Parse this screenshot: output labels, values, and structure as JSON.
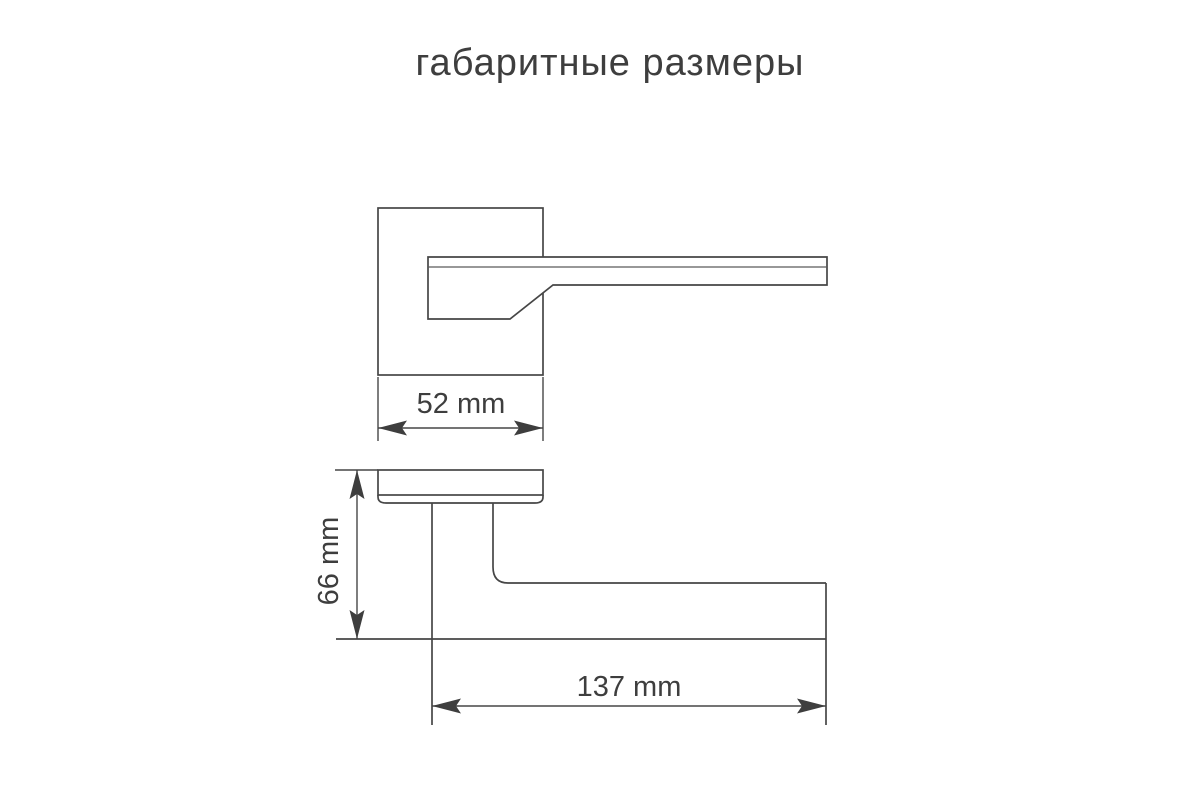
{
  "title": "габаритные размеры",
  "drawing": {
    "type": "technical-dimension-drawing",
    "subject": "door-lever-handle-on-square-rosette",
    "background_color": "#ffffff",
    "line_color": "#464646",
    "text_color": "#3e3e3e",
    "views": [
      {
        "id": "front-view",
        "description": "handle front view with square rosette plate"
      },
      {
        "id": "side-view",
        "description": "handle side profile view"
      }
    ],
    "dimensions": {
      "rosette_width": {
        "label": "52 mm",
        "value": 52,
        "unit": "mm",
        "orientation": "horizontal",
        "applies_to": "front-view"
      },
      "handle_height": {
        "label": "66 mm",
        "value": 66,
        "unit": "mm",
        "orientation": "vertical",
        "applies_to": "side-view"
      },
      "handle_length": {
        "label": "137 mm",
        "value": 137,
        "unit": "mm",
        "orientation": "horizontal",
        "applies_to": "side-view"
      }
    }
  }
}
